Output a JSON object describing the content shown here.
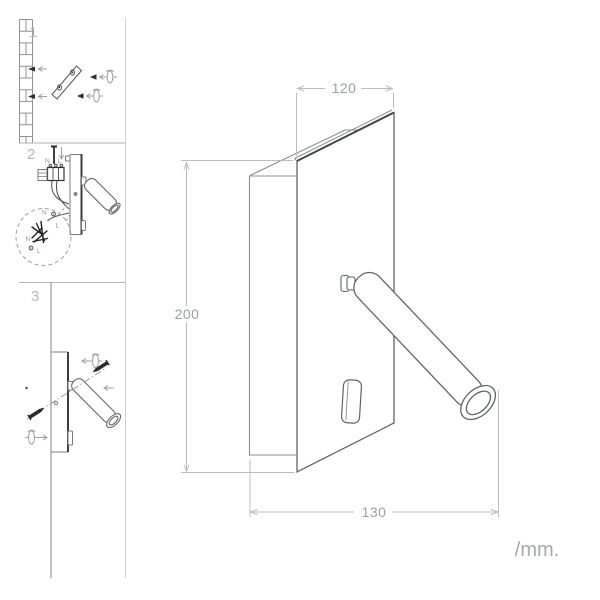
{
  "drawing": {
    "unit_label": "/mm.",
    "dimensions": {
      "width_top": "120",
      "height": "200",
      "width_bottom": "130"
    },
    "steps": [
      {
        "number": "1"
      },
      {
        "number": "2"
      },
      {
        "number": "3"
      }
    ],
    "wiring_labels": {
      "line_top": {
        "n": "N",
        "l": "L"
      },
      "balloon": {
        "n1": "N",
        "l1": "L",
        "n2": "N",
        "l2": "L"
      }
    },
    "colors": {
      "outline": "#5f6467",
      "outline_dark": "#45494c",
      "outline_light": "#8a8e91",
      "dimension_line": "#b9bdc0",
      "dimension_text": "#9aa0a3",
      "step_number": "#b3b6b8",
      "screw_dark": "#2a2a2a",
      "background": "#ffffff"
    }
  }
}
